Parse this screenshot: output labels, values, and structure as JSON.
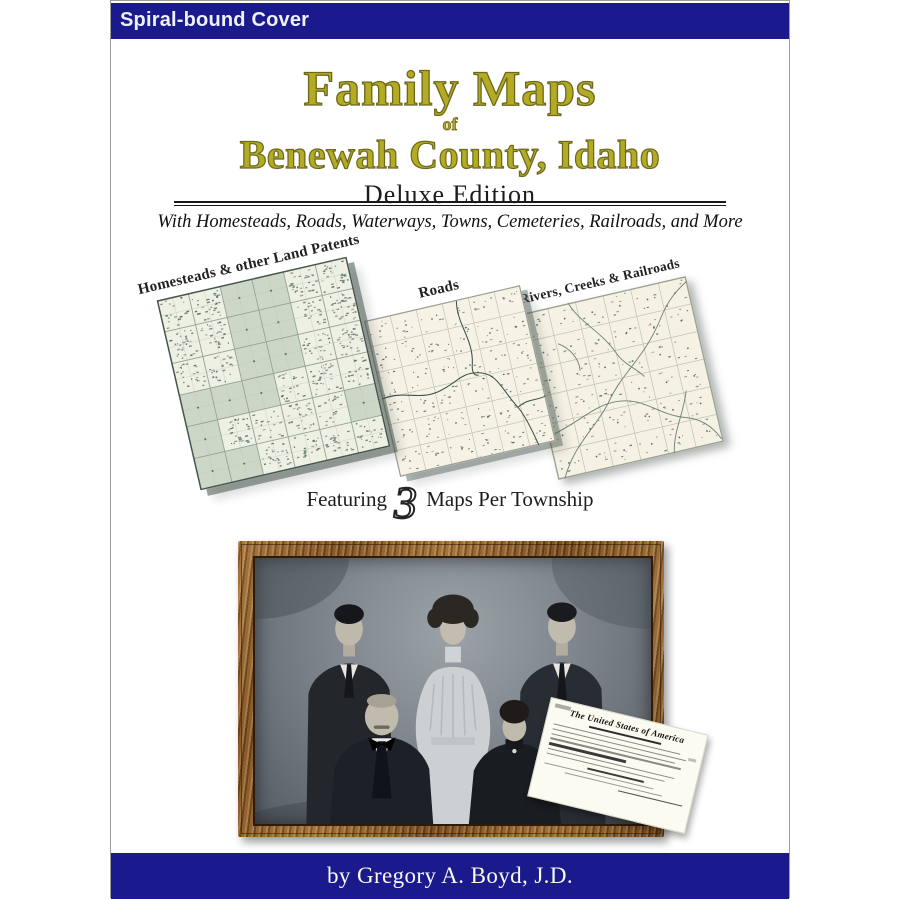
{
  "cover": {
    "binding_label": "Spiral-bound Cover",
    "title": {
      "line1": "Family Maps",
      "connector": "of",
      "line2": "Benewah County, Idaho"
    },
    "edition": "Deluxe Edition",
    "subtitle": "With Homesteads, Roads, Waterways, Towns, Cemeteries, Railroads, and More"
  },
  "maps": {
    "panels": [
      {
        "label": "Homesteads & other Land Patents"
      },
      {
        "label": "Roads"
      },
      {
        "label": "Rivers, Creeks & Railroads"
      }
    ],
    "featuring": {
      "prefix": "Featuring",
      "number": "3",
      "suffix": "Maps Per Township"
    }
  },
  "photo": {
    "alt": "black and white family portrait of five people in an ornate wooden frame"
  },
  "document": {
    "heading": "The United States of America"
  },
  "byline": {
    "text": "by Gregory A. Boyd, J.D."
  },
  "colors": {
    "navy": "#1a1a8c",
    "title_gold": "#b3ab24",
    "title_gold_outline": "#6d671a",
    "map_shaded_cell": "#ccd7c8",
    "map_paper": "#f5f2e4",
    "frame_wood": "#8a5a28"
  }
}
